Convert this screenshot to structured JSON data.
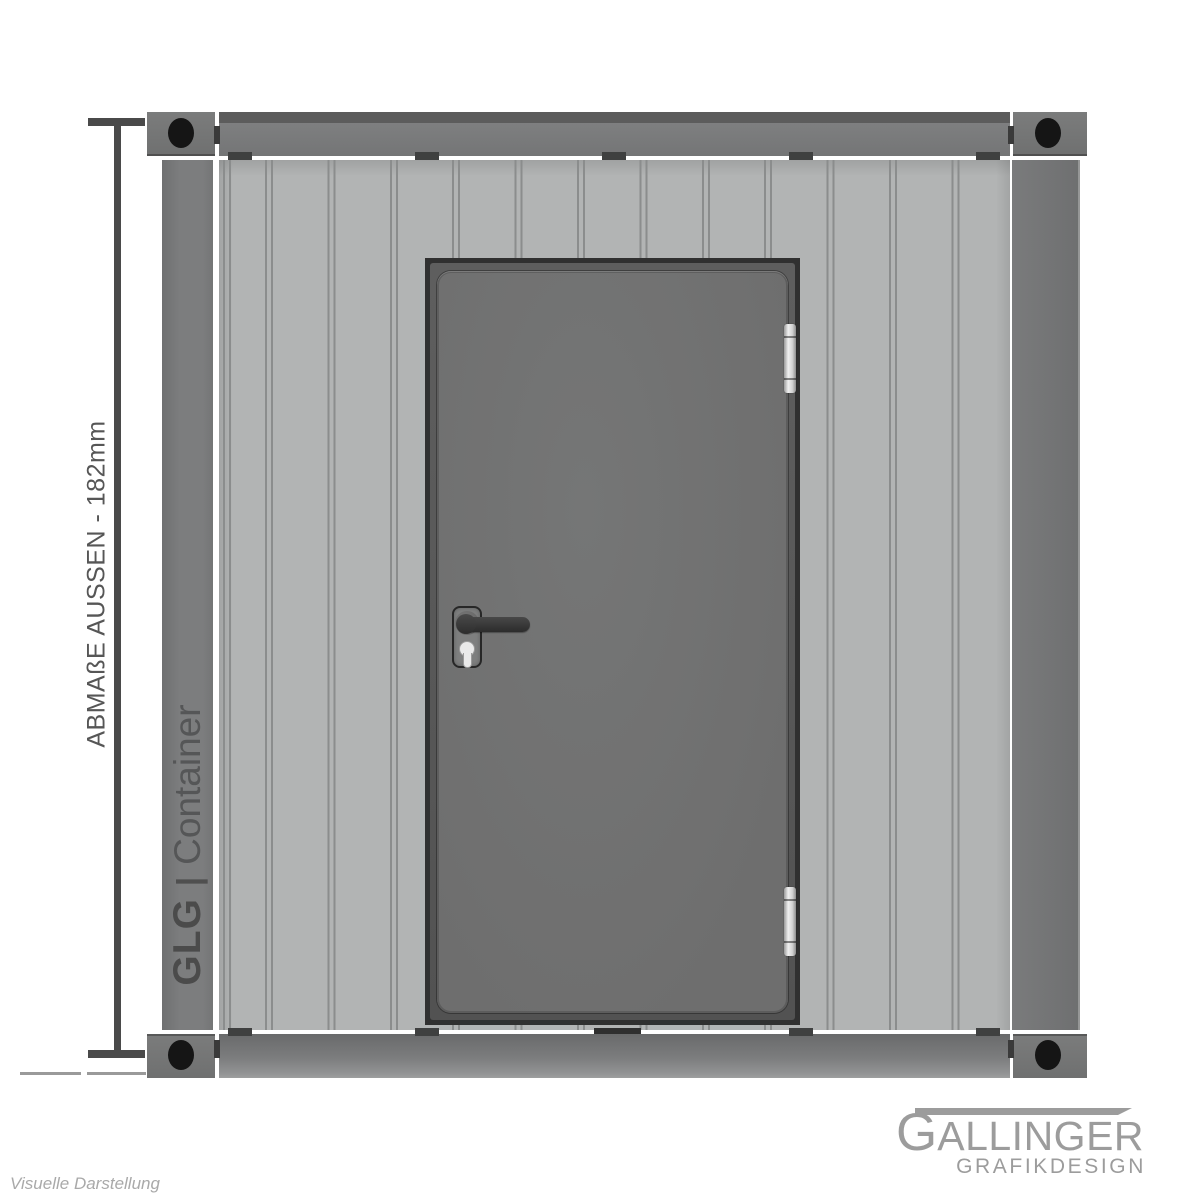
{
  "illustration": {
    "dimension_label": "ABMAßE AUSSEN - 182mm",
    "branding": {
      "primary": "GLG",
      "separator": "|",
      "secondary": "Container"
    }
  },
  "footer": {
    "logo": {
      "initial": "G",
      "name_rest": "ALLINGER",
      "subtitle": "GRAFIKDESIGN"
    },
    "caption": "Visuelle Darstellung"
  },
  "colors": {
    "wall": "#b2b4b4",
    "seam": "#8b8d8d",
    "structureDark": "#5c5c5c",
    "casting": "#757575",
    "hole": "#151515",
    "doorFrame": "#303030",
    "doorLeaf": "#6e6e6e",
    "hinge": "#d2d2d2",
    "dimension": "#4a4a4a",
    "brandText": "#4b4b4b",
    "logoGray": "#9c9c9c",
    "captionGray": "#a9a9a9"
  }
}
